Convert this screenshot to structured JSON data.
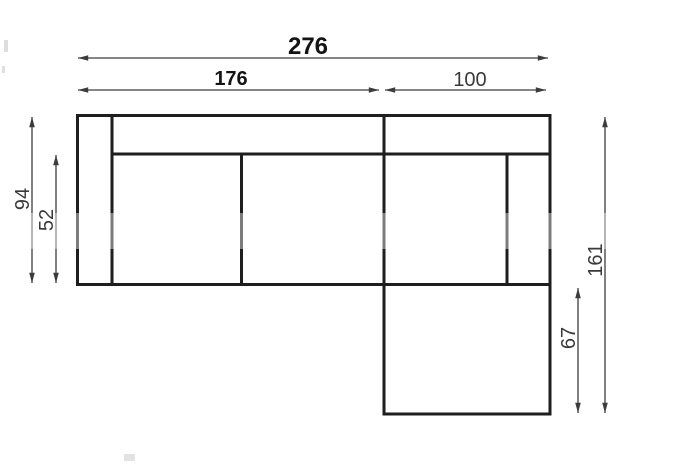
{
  "diagram": {
    "kind": "sofa-top-view-dimension-drawing"
  },
  "colors": {
    "background": "#ffffff",
    "outline": "#1e1e1e",
    "dimension": "#3c3c3c",
    "bold_label": "#141414"
  },
  "dimensions": {
    "overall_width": "276",
    "left_section_width": "176",
    "chaise_width": "100",
    "left_total_depth": "94",
    "left_seat_depth": "52",
    "right_total_depth": "161",
    "chaise_extension": "67"
  }
}
